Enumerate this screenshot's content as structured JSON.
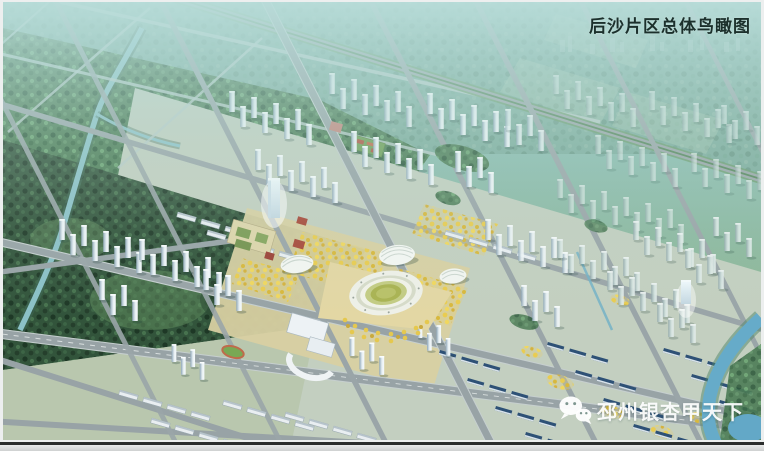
{
  "caption": {
    "title": "后沙片区总体鸟瞰图"
  },
  "watermark": {
    "text": "邳州银杏甲天下",
    "icon": "wechat-icon"
  },
  "palette": {
    "haze_teal": "#8fc2bd",
    "forest_dark": "#32543b",
    "forest_mid": "#4c7c55",
    "road_gray": "#9aa5a8",
    "ginkgo_yellow": "#e8cb52",
    "stadium_field": "#a9b352",
    "water_blue": "#66abc9",
    "roof_navy": "#2e5176",
    "building_white": "#eef3f6",
    "frame_line": "#2c2e2d",
    "title_color": "#1c302c"
  }
}
